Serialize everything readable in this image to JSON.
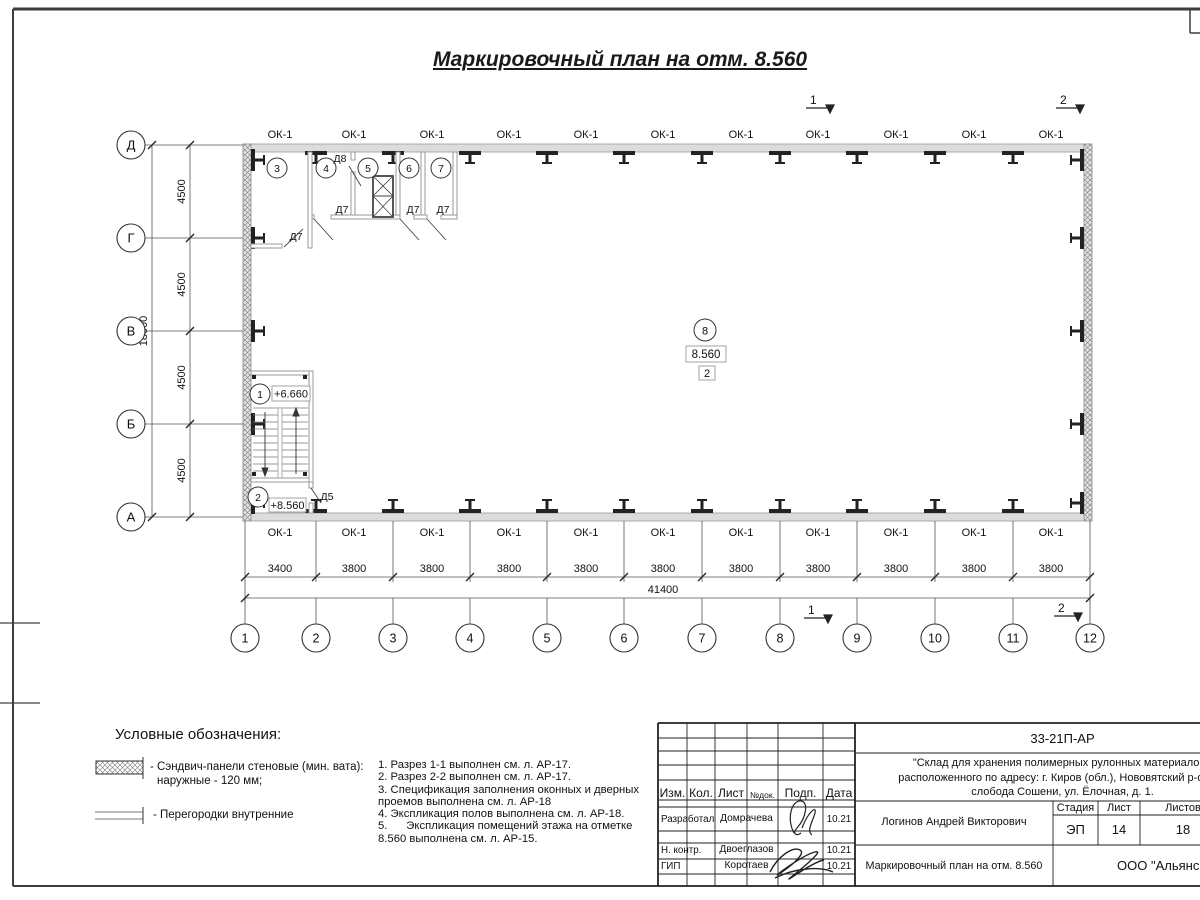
{
  "sheet": {
    "title": "Маркировочный план на отм. 8.560"
  },
  "plan": {
    "window_label": "ОК-1",
    "axis_rows": [
      "Д",
      "Г",
      "В",
      "Б",
      "А"
    ],
    "axis_cols": [
      "1",
      "2",
      "3",
      "4",
      "5",
      "6",
      "7",
      "8",
      "9",
      "10",
      "11",
      "12"
    ],
    "rooms": [
      "1",
      "2",
      "3",
      "4",
      "5",
      "6",
      "7",
      "8"
    ],
    "dims": {
      "bay_h": "4500",
      "total_h": "18000",
      "bay1_w": "3400",
      "bay_w": "3800",
      "total_w": "41400"
    },
    "elevations": {
      "landing": "+6.660",
      "floor": "+8.560",
      "room8": "8.560",
      "room8_note": "2"
    },
    "doors": {
      "d5": "Д5",
      "d7": "Д7",
      "d8": "Д8"
    },
    "sections": {
      "s1": "1",
      "s2": "2"
    }
  },
  "legend": {
    "title": "Условные обозначения:",
    "item1_line1": "- Сэндвич-панели стеновые (мин. вата):",
    "item1_line2": "наружные - 120 мм;",
    "item2": "- Перегородки внутренние"
  },
  "notes": {
    "lines": [
      "1. Разрез 1-1 выполнен см. л. АР-17.",
      "2. Разрез 2-2 выполнен см. л. АР-17.",
      "3. Спецификация заполнения оконных и дверных",
      "проемов выполнена см. л. АР-18",
      "4. Экспликация полов выполнена см. л. АР-18.",
      "5.      Экспликация помещений этажа на отметке",
      "8.560 выполнена см. л. АР-15."
    ]
  },
  "titleblock": {
    "code": "33-21П-АР",
    "project_line1": "\"Склад для хранения полимерных рулонных материалов\",",
    "project_line2": "расположенного по адресу: г. Киров (обл.), Нововятский р-он, те",
    "project_line3": "слобода Сошени, ул. Ёлочная, д. 1.",
    "col_izm": "Изм.",
    "col_kol": "Кол.",
    "col_list": "Лист",
    "col_ndok": "№док.",
    "col_podp": "Подп.",
    "col_data": "Дата",
    "row1_role": "Разработал",
    "row1_name": "Домрачева",
    "row1_date": "10.21",
    "row2_role": "Н. контр.",
    "row2_name": "Двоеглазов",
    "row2_date": "10.21",
    "row3_role": "ГИП",
    "row3_name": "Коротаев",
    "row3_date": "10.21",
    "chief_name": "Логинов Андрей Викторович",
    "stadia_label": "Стадия",
    "list_label": "Лист",
    "listov_label": "Листов",
    "stadia": "ЭП",
    "list": "14",
    "listov": "18",
    "drawing_title": "Маркировочный план на отм. 8.560",
    "company": "ООО \"Альянс\""
  }
}
